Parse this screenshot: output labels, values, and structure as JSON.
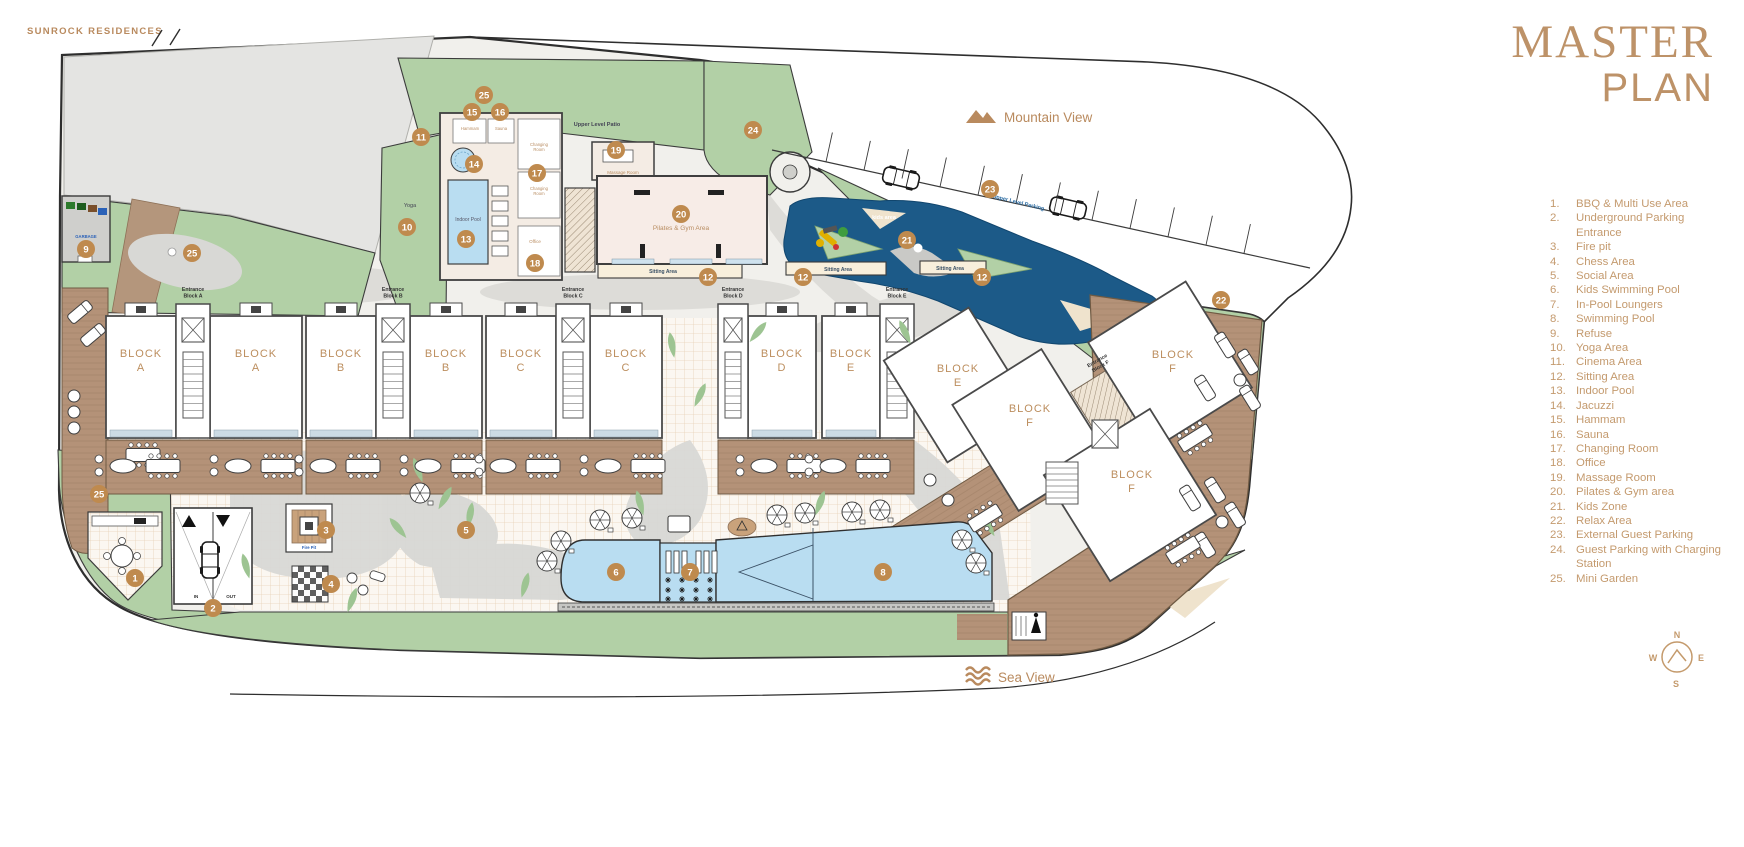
{
  "brand": "SUNROCK RESIDENCES",
  "title": {
    "line1": "MASTER",
    "line2": "PLAN"
  },
  "views": {
    "mountain": "Mountain View",
    "sea": "Sea View"
  },
  "compass": {
    "n": "N",
    "e": "E",
    "s": "S",
    "w": "W"
  },
  "colors": {
    "accent": "#bd9268",
    "marker": "#bf8a4e",
    "green": "#b2d0a6",
    "kids_blue": "#1c5a88",
    "water": "#b9ddf1",
    "wood": "#b49278",
    "building": "#f7ece7",
    "parcel": "#e4e4e2",
    "path_gray": "#d8d8d5",
    "tile_line": "#e7d2b8",
    "boundary": "#2e2e2e",
    "blue_label": "#2b6ca3"
  },
  "legend": [
    {
      "num": "1.",
      "label": "BBQ & Multi Use Area"
    },
    {
      "num": "2.",
      "label": "Underground Parking Entrance"
    },
    {
      "num": "3.",
      "label": "Fire pit"
    },
    {
      "num": "4.",
      "label": "Chess Area"
    },
    {
      "num": "5.",
      "label": "Social Area"
    },
    {
      "num": "6.",
      "label": "Kids Swimming Pool"
    },
    {
      "num": "7.",
      "label": "In-Pool Loungers"
    },
    {
      "num": "8.",
      "label": "Swimming Pool"
    },
    {
      "num": "9.",
      "label": "Refuse"
    },
    {
      "num": "10.",
      "label": "Yoga Area"
    },
    {
      "num": "11.",
      "label": "Cinema Area"
    },
    {
      "num": "12.",
      "label": "Sitting Area"
    },
    {
      "num": "13.",
      "label": "Indoor Pool"
    },
    {
      "num": "14.",
      "label": "Jacuzzi"
    },
    {
      "num": "15.",
      "label": "Hammam"
    },
    {
      "num": "16.",
      "label": "Sauna"
    },
    {
      "num": "17.",
      "label": "Changing Room"
    },
    {
      "num": "18.",
      "label": "Office"
    },
    {
      "num": "19.",
      "label": "Massage Room"
    },
    {
      "num": "20.",
      "label": "Pilates & Gym area"
    },
    {
      "num": "21.",
      "label": "Kids Zone"
    },
    {
      "num": "22.",
      "label": "Relax Area"
    },
    {
      "num": "23.",
      "label": "External Guest Parking"
    },
    {
      "num": "24.",
      "label": "Guest Parking with Charging Station"
    },
    {
      "num": "25.",
      "label": "Mini Garden"
    }
  ],
  "plan": {
    "block_word": "BLOCK",
    "blocks": [
      {
        "letter": "A",
        "x": 141,
        "y": 357
      },
      {
        "letter": "A",
        "x": 256,
        "y": 357
      },
      {
        "letter": "B",
        "x": 341,
        "y": 357
      },
      {
        "letter": "B",
        "x": 446,
        "y": 357
      },
      {
        "letter": "C",
        "x": 521,
        "y": 357
      },
      {
        "letter": "C",
        "x": 626,
        "y": 357
      },
      {
        "letter": "D",
        "x": 782,
        "y": 357
      },
      {
        "letter": "E",
        "x": 851,
        "y": 357
      },
      {
        "letter": "E",
        "x": 958,
        "y": 372
      },
      {
        "letter": "F",
        "x": 1030,
        "y": 412
      },
      {
        "letter": "F",
        "x": 1173,
        "y": 358
      },
      {
        "letter": "F",
        "x": 1132,
        "y": 478
      }
    ],
    "entrances": [
      {
        "l1": "Entrance",
        "l2": "Block A",
        "x": 193,
        "y": 291
      },
      {
        "l1": "Entrance",
        "l2": "Block B",
        "x": 393,
        "y": 291
      },
      {
        "l1": "Entrance",
        "l2": "Block C",
        "x": 573,
        "y": 291
      },
      {
        "l1": "Entrance",
        "l2": "Block D",
        "x": 733,
        "y": 291
      },
      {
        "l1": "Entrance",
        "l2": "Block E",
        "x": 897,
        "y": 291
      },
      {
        "l1": "Entrance",
        "l2": "Block F",
        "x": 1098,
        "y": 362,
        "rot": -30
      }
    ],
    "labels": [
      {
        "text": "Pilates & Gym Area",
        "x": 681,
        "y": 230,
        "size": 6.5,
        "color": "#b98d62"
      },
      {
        "text": "Sitting Area",
        "x": 663,
        "y": 273,
        "size": 5,
        "color": "#3b5166",
        "bold": true
      },
      {
        "text": "Sitting Area",
        "x": 838,
        "y": 271,
        "size": 5,
        "color": "#3b5166",
        "bold": true
      },
      {
        "text": "Sitting Area",
        "x": 950,
        "y": 270,
        "size": 5,
        "color": "#3b5166",
        "bold": true
      },
      {
        "text": "kids area",
        "x": 884,
        "y": 219,
        "size": 5.5,
        "color": "#ffffff",
        "bold": true
      },
      {
        "text": "Upper Level Parking",
        "x": 1018,
        "y": 204,
        "size": 5.5,
        "color": "#2b6ca3",
        "rot": 14,
        "bold": true
      },
      {
        "text": "Upper Level Patio",
        "x": 597,
        "y": 126,
        "size": 5.5,
        "color": "#445",
        "bold": true
      },
      {
        "text": "Yoga",
        "x": 410,
        "y": 207,
        "size": 5.5,
        "color": "#445"
      },
      {
        "text": "Massage Room",
        "x": 623,
        "y": 174,
        "size": 4.5,
        "color": "#b98d62"
      },
      {
        "text": "Indoor Pool",
        "x": 468,
        "y": 221,
        "size": 5,
        "color": "#556"
      },
      {
        "text": "Hammam",
        "x": 470,
        "y": 130,
        "size": 4.2,
        "color": "#b98d62"
      },
      {
        "text": "Sauna",
        "x": 501,
        "y": 130,
        "size": 4.2,
        "color": "#b98d62"
      },
      {
        "text": "Changing\nRoom",
        "x": 539,
        "y": 146,
        "size": 4.2,
        "color": "#b98d62"
      },
      {
        "text": "Changing\nRoom",
        "x": 539,
        "y": 190,
        "size": 4.2,
        "color": "#b98d62"
      },
      {
        "text": "Office",
        "x": 535,
        "y": 243,
        "size": 4.5,
        "color": "#b98d62"
      },
      {
        "text": "Fire Pit",
        "x": 309,
        "y": 549,
        "size": 4.2,
        "color": "#2b62b8",
        "bold": true
      },
      {
        "text": "GARBAGE",
        "x": 86,
        "y": 238,
        "size": 4.2,
        "color": "#2b62b8",
        "bold": true
      },
      {
        "text": "IN",
        "x": 196,
        "y": 598,
        "size": 4.5,
        "color": "#333",
        "bold": true
      },
      {
        "text": "OUT",
        "x": 231,
        "y": 598,
        "size": 4.5,
        "color": "#333",
        "bold": true
      }
    ],
    "markers": [
      {
        "n": "1",
        "x": 135,
        "y": 578
      },
      {
        "n": "2",
        "x": 213,
        "y": 608
      },
      {
        "n": "3",
        "x": 326,
        "y": 530
      },
      {
        "n": "4",
        "x": 331,
        "y": 584
      },
      {
        "n": "5",
        "x": 466,
        "y": 530
      },
      {
        "n": "6",
        "x": 616,
        "y": 572
      },
      {
        "n": "7",
        "x": 690,
        "y": 572
      },
      {
        "n": "8",
        "x": 883,
        "y": 572
      },
      {
        "n": "9",
        "x": 86,
        "y": 249
      },
      {
        "n": "10",
        "x": 407,
        "y": 227
      },
      {
        "n": "11",
        "x": 421,
        "y": 137
      },
      {
        "n": "12",
        "x": 708,
        "y": 277
      },
      {
        "n": "12",
        "x": 803,
        "y": 277
      },
      {
        "n": "12",
        "x": 982,
        "y": 277
      },
      {
        "n": "13",
        "x": 466,
        "y": 239
      },
      {
        "n": "14",
        "x": 474,
        "y": 164
      },
      {
        "n": "15",
        "x": 472,
        "y": 112
      },
      {
        "n": "16",
        "x": 500,
        "y": 112
      },
      {
        "n": "17",
        "x": 537,
        "y": 173
      },
      {
        "n": "18",
        "x": 535,
        "y": 263
      },
      {
        "n": "19",
        "x": 616,
        "y": 150
      },
      {
        "n": "20",
        "x": 681,
        "y": 214
      },
      {
        "n": "21",
        "x": 907,
        "y": 240
      },
      {
        "n": "22",
        "x": 1221,
        "y": 300
      },
      {
        "n": "23",
        "x": 990,
        "y": 189
      },
      {
        "n": "24",
        "x": 753,
        "y": 130
      },
      {
        "n": "25",
        "x": 484,
        "y": 95
      },
      {
        "n": "25",
        "x": 192,
        "y": 253
      },
      {
        "n": "25",
        "x": 99,
        "y": 494
      }
    ]
  }
}
